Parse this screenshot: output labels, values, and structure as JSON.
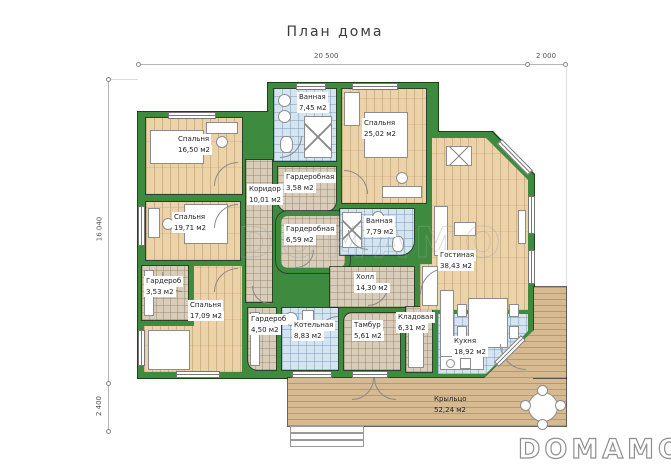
{
  "title": "План дома",
  "dimensions": {
    "top_main": "20 500",
    "top_right": "2 000",
    "left_main": "16 040",
    "left_bottom": "2 400"
  },
  "rooms": [
    {
      "name": "Спальня",
      "area": "16,50 м2"
    },
    {
      "name": "Спальня",
      "area": "19,71 м2"
    },
    {
      "name": "Спальня",
      "area": "17,09 м2"
    },
    {
      "name": "Гардероб",
      "area": "3,53 м2"
    },
    {
      "name": "Коридор",
      "area": "10,01 м2"
    },
    {
      "name": "Ванная",
      "area": "7,45 м2"
    },
    {
      "name": "Гардеробная",
      "area": "3,58 м2"
    },
    {
      "name": "Гардеробная",
      "area": "6,59 м2"
    },
    {
      "name": "Спальня",
      "area": "25,02 м2"
    },
    {
      "name": "Ванная",
      "area": "7,79 м2"
    },
    {
      "name": "Холл",
      "area": "14,30 м2"
    },
    {
      "name": "Гардероб",
      "area": "4,50 м2"
    },
    {
      "name": "Котельная",
      "area": "8,83 м2"
    },
    {
      "name": "Тамбур",
      "area": "5,61 м2"
    },
    {
      "name": "Кладовая",
      "area": "6,31 м2"
    },
    {
      "name": "Гостиная",
      "area": "38,43 м2"
    },
    {
      "name": "Кухня",
      "area": "18,92 м2"
    },
    {
      "name": "Крыльцо",
      "area": "52,24 м2"
    }
  ],
  "watermark": "DOMAMO",
  "logo": "DOMAMO",
  "colors": {
    "wall_green": "#3e8a3e",
    "wood_floor": "#ecd2a9",
    "tile_blue": "#d4e4f0",
    "tile_beige": "#d8cdbb",
    "deck_wood": "#d6bb92"
  }
}
